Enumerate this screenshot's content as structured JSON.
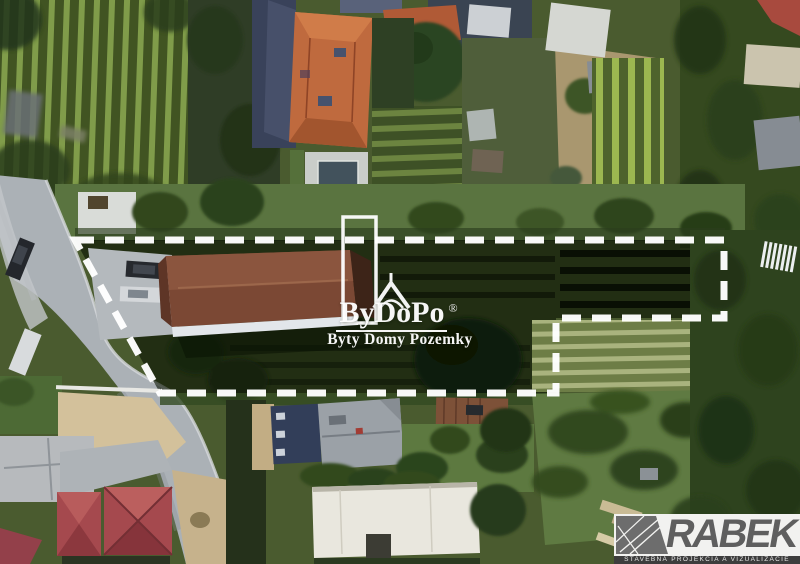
{
  "watermark": {
    "brand": "ByDoPo",
    "registered": "®",
    "tagline": "Byty Domy Pozemky"
  },
  "developer": {
    "name": "RABEK",
    "tagline": "STAVEBNÁ PROJEKCIA A VIZUALIZÁCIE"
  },
  "icons": {
    "watermark_glyph": "house-door-outline-icon",
    "rabek_glyph": "blueprint-lines-icon"
  },
  "colors": {
    "boundary_dash": "#ffffff",
    "watermark_text": "#ffffff",
    "proposed_roof": "#7b4834",
    "parcel_shade": "#0a1404",
    "road": "#abb1b6",
    "rabek_text": "#5f5f5f",
    "rabek_strip_bg": "#3d3d3d",
    "rabek_strip_text": "#e9e9e9"
  }
}
